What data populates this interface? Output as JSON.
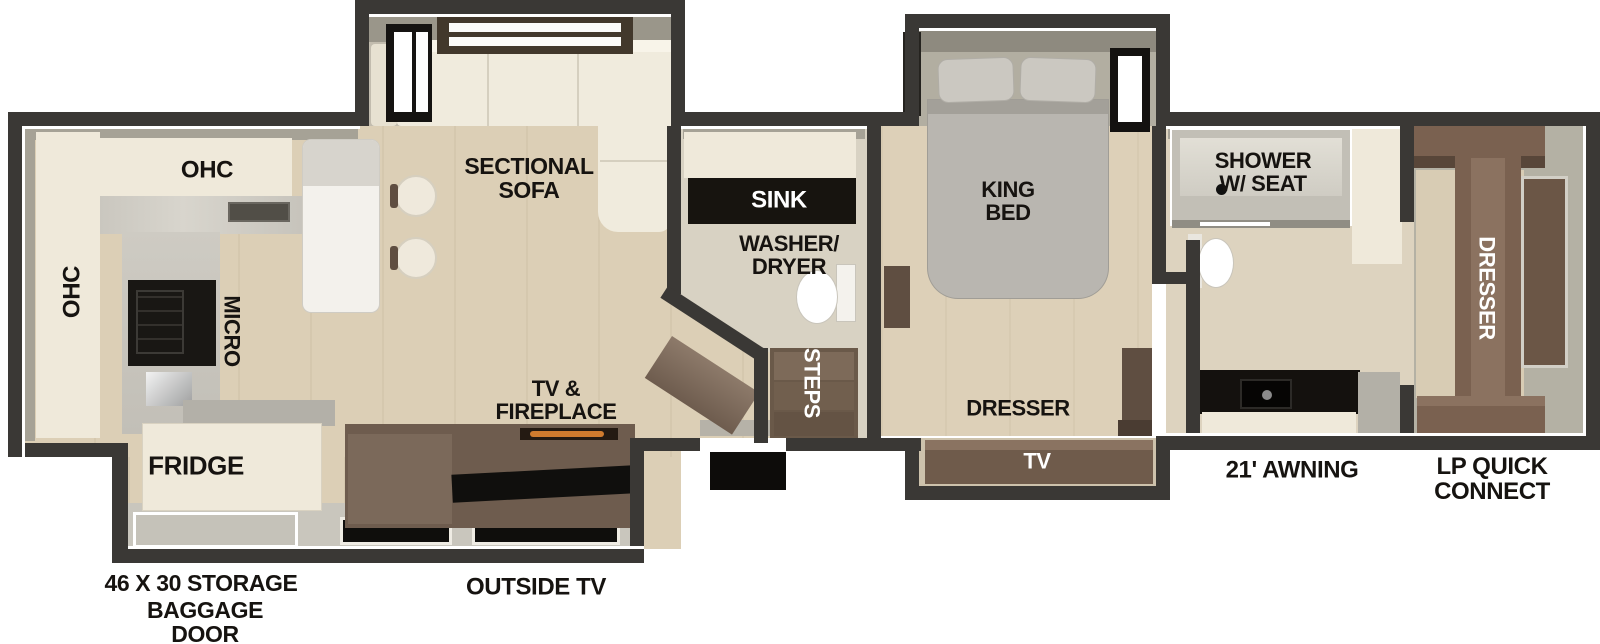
{
  "diagram_type": "rv-fifth-wheel-floorplan",
  "colors": {
    "wall": "#3a3835",
    "floor_wood": "#dccfb6",
    "floor_bath": "#d8d2c3",
    "cabinet_cream": "#efe9da",
    "furniture_brown": "#7a6150",
    "furniture_dark_brown": "#5f4e41",
    "counter_black": "#14120f",
    "bed_gray": "#b9b6b0",
    "fireplace_accent": "#d07b2e"
  },
  "labels": {
    "ohc_top": "OHC",
    "ohc_left": "OHC",
    "micro": "MICRO",
    "fridge": "FRIDGE",
    "sectional_sofa_line1": "SECTIONAL",
    "sectional_sofa_line2": "SOFA",
    "sink": "SINK",
    "washer_dryer_line1": "WASHER/",
    "washer_dryer_line2": "DRYER",
    "steps": "STEPS",
    "tv_fireplace_line1": "TV &",
    "tv_fireplace_line2": "FIREPLACE",
    "king_bed_line1": "KING",
    "king_bed_line2": "BED",
    "bedroom_dresser": "DRESSER",
    "bedroom_tv": "TV",
    "shower_line1": "SHOWER",
    "shower_line2": "W/ SEAT",
    "front_dresser": "DRESSER",
    "awning": "21' AWNING",
    "lp_connect_line1": "LP QUICK",
    "lp_connect_line2": "CONNECT",
    "storage": "46 X 30 STORAGE",
    "baggage_line1": "BAGGAGE",
    "baggage_line2": "DOOR",
    "outside_tv": "OUTSIDE TV"
  }
}
